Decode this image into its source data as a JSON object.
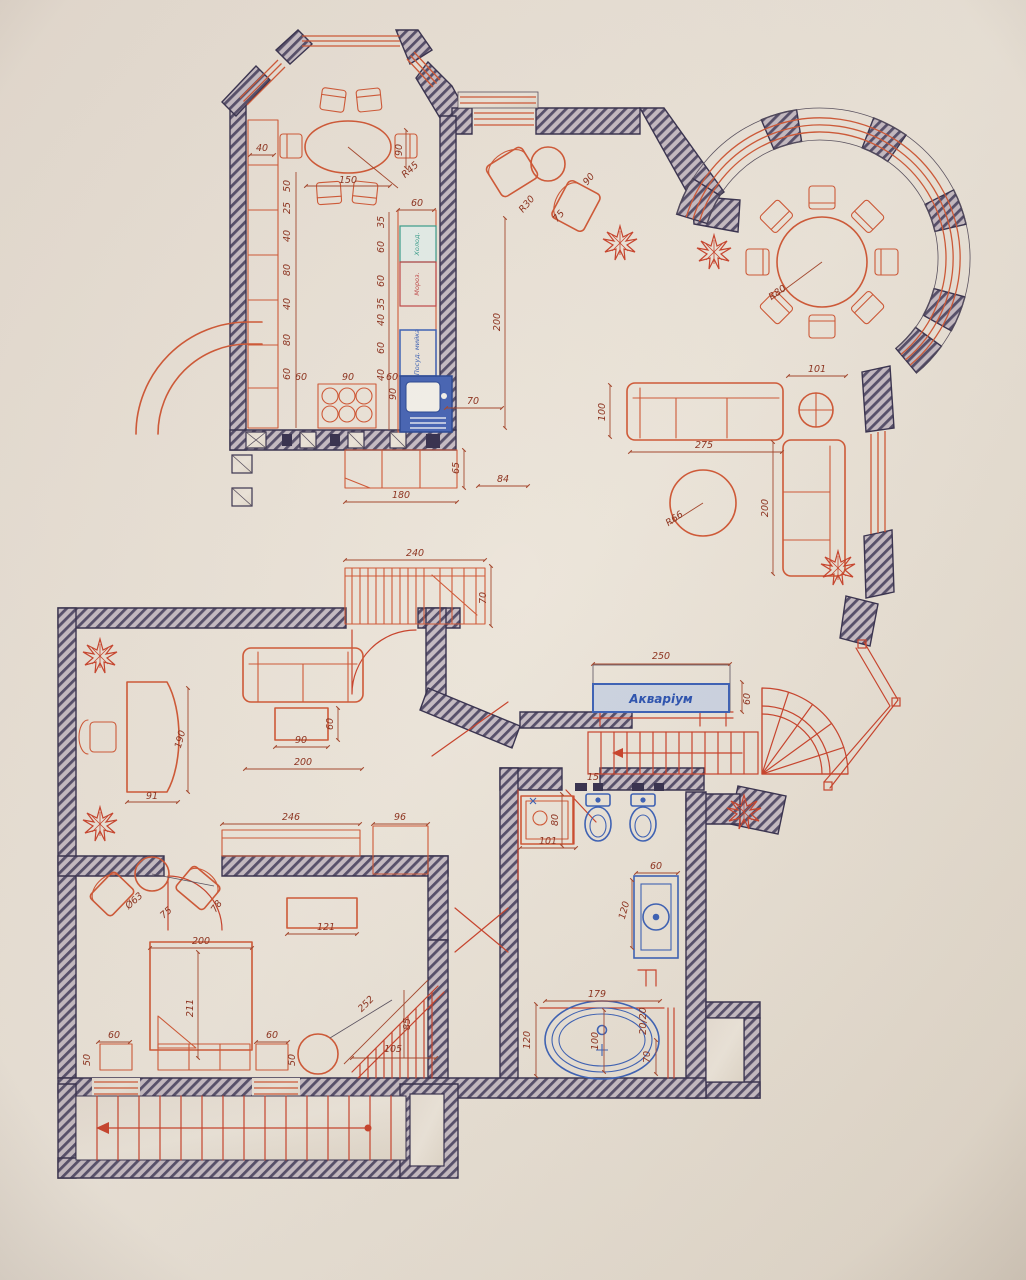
{
  "drawing": {
    "labels": {
      "aquarium": "Акваріум",
      "dishwasher": "Посуд. мийка",
      "fridge": "Холод.",
      "freezer": "Мороз."
    },
    "dims": {
      "bay_width_40": "40",
      "bay_chair_90": "90",
      "table_150": "150",
      "table_r45": "R45",
      "chain_50": "50",
      "chain_25": "25",
      "chain_40a": "40",
      "chain_80a": "80",
      "chain_40b": "40",
      "chain_80b": "80",
      "chain_60": "60",
      "stove_60l": "60",
      "stove_90": "90",
      "stove_60r": "60",
      "counter_60top": "60",
      "counter_35a": "35",
      "counter_60a": "60",
      "counter_60b": "60",
      "counter_35b": "35",
      "counter_40a": "40",
      "counter_60c": "60",
      "counter_40b": "40",
      "counter_90": "90",
      "counter_70": "70",
      "kitchen_200": "200",
      "cab_180": "180",
      "cab_65": "65",
      "cab_84": "84",
      "ward_240": "240",
      "ward_70": "70",
      "entry_90": "90",
      "entry_r30": "R30",
      "entry_75": "75",
      "rotunda_r80": "R80",
      "sofa_100": "100",
      "sofa_275": "275",
      "side_101": "101",
      "sofa_200": "200",
      "pouf_r66": "R66",
      "aq_250": "250",
      "aq_60": "60",
      "hall_246": "246",
      "hall_96": "96",
      "office_190": "190",
      "office_91": "91",
      "office_90": "90",
      "office_60": "60",
      "office_200": "200",
      "bed_200": "200",
      "bed_211": "211",
      "bed_60l": "60",
      "bed_60r": "60",
      "bed_50l": "50",
      "bed_50r": "50",
      "bench_121": "121",
      "chair_d63": "Ø63",
      "chair_75": "75",
      "chair_78": "78",
      "stair_252": "252",
      "stair_105": "105",
      "stair_85": "85",
      "bath_101": "101",
      "bath_80": "80",
      "bath_15": "15",
      "van_60": "60",
      "van_120": "120",
      "tub_179": "179",
      "tub_120": "120",
      "tub_100": "100",
      "tub_2020": "20/20",
      "tub_70": "70"
    },
    "colors": {
      "paper": "#eae3d8",
      "wall_hatch": "#57506b",
      "furniture": "#d05a38",
      "dimension_text": "#8e3420",
      "plumbing": "#3f63b5",
      "aquarium_label": "#2f55b0",
      "fridge_label": "#3a9e8c",
      "freezer_label": "#c04848"
    }
  }
}
